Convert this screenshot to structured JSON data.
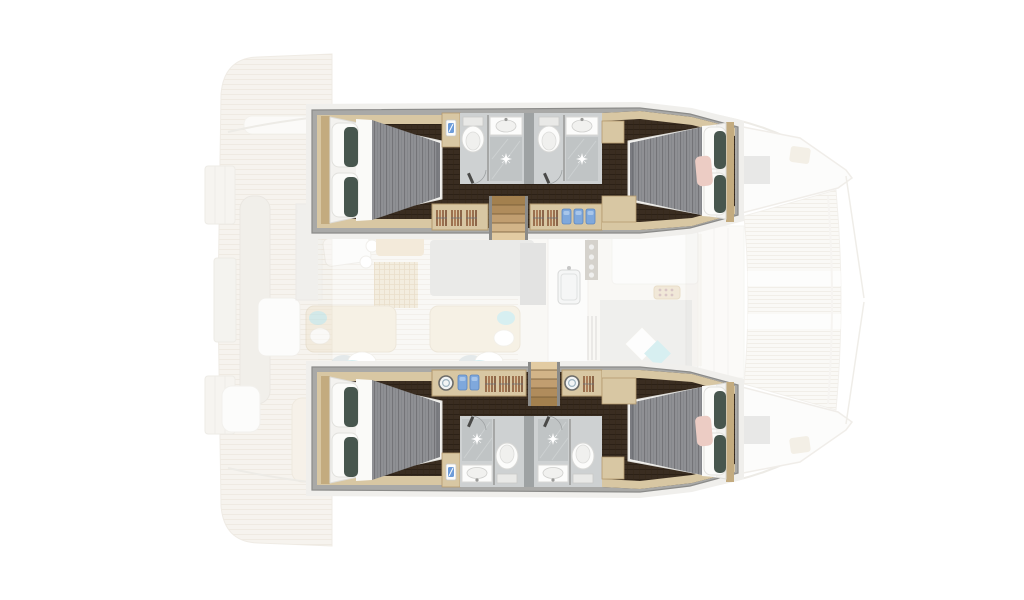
{
  "image_kind": "catamaran-yacht-floor-plan-top-view",
  "visible_text": [],
  "palette": {
    "bg": "#ffffff",
    "wall_gray": "#a9a9a7",
    "wall_line": "#8b8b89",
    "deck_halo": "#f0efec",
    "floor_dark": "#3a2d21",
    "trim_wood": "#d8c7a3",
    "trim_wood_dark": "#c3ab7f",
    "bath_floor": "#ced1d2",
    "bath_tile": "#c0c4c5",
    "bath_panel": "#9ea2a3",
    "fixture_white": "#fcfcfb",
    "fixture_line": "#d8d8d6",
    "bedding_white": "#f3f2ef",
    "duvet": "#85878b",
    "pillow_white": "#fbfbf9",
    "pillow_teal": "#47564e",
    "pillow_pink": "#ecccc4",
    "accent_blue": "#6d9cd9",
    "accent_teal_light": "#b8e2e6",
    "hanger_brown": "#8a5a3a",
    "faded_beige": "#f0ebe1",
    "faded_line": "#e2dacb",
    "faded_white": "#fafaf8",
    "rug": "#eadfc6",
    "rug_line": "#d9c5a0",
    "step_light": "#e2cba2",
    "step_dark": "#a3804e"
  },
  "areas": {
    "port_hull": {
      "cabins": [
        {
          "name": "aft-port-cabin",
          "features": [
            "double-bed-head-left",
            "teal-accent-pillows",
            "nightstand-lamp",
            "wardrobe-hangers"
          ]
        },
        {
          "name": "forward-port-cabin",
          "features": [
            "double-bed-head-right",
            "teal-accent-pillows",
            "pink-accent-pillow"
          ]
        }
      ],
      "bathrooms": [
        {
          "name": "aft-port-head",
          "features": [
            "toilet",
            "sink",
            "shower"
          ]
        },
        {
          "name": "forward-port-head",
          "features": [
            "toilet",
            "sink",
            "shower"
          ]
        }
      ],
      "companionway": {
        "name": "port-steps",
        "treads": 5
      }
    },
    "starboard_hull": {
      "cabins": [
        {
          "name": "aft-starboard-cabin",
          "features": [
            "double-bed-head-left",
            "teal-accent-pillows",
            "nightstand-lamp",
            "wardrobe-hangers"
          ]
        },
        {
          "name": "forward-starboard-cabin",
          "features": [
            "double-bed-head-right",
            "teal-accent-pillows",
            "pink-accent-pillow"
          ]
        }
      ],
      "bathrooms": [
        {
          "name": "aft-starboard-head",
          "features": [
            "shower",
            "sink",
            "toilet"
          ]
        },
        {
          "name": "forward-starboard-head",
          "features": [
            "shower",
            "sink",
            "toilet"
          ]
        }
      ],
      "companionway": {
        "name": "starboard-steps",
        "treads": 5
      }
    },
    "saloon_faded": [
      "dinette-table",
      "area-rug",
      "saloon-table",
      "chaise-lounges",
      "toss-pillows",
      "galley-sink",
      "galley-stove",
      "lounge-with-diamond-cushions"
    ],
    "exterior_faded": [
      "aft-deck",
      "swim-platforms",
      "cockpit-bench",
      "cockpit-table",
      "bow-port",
      "bow-starboard",
      "trampoline",
      "deck-hatches",
      "bridle-lines"
    ]
  }
}
